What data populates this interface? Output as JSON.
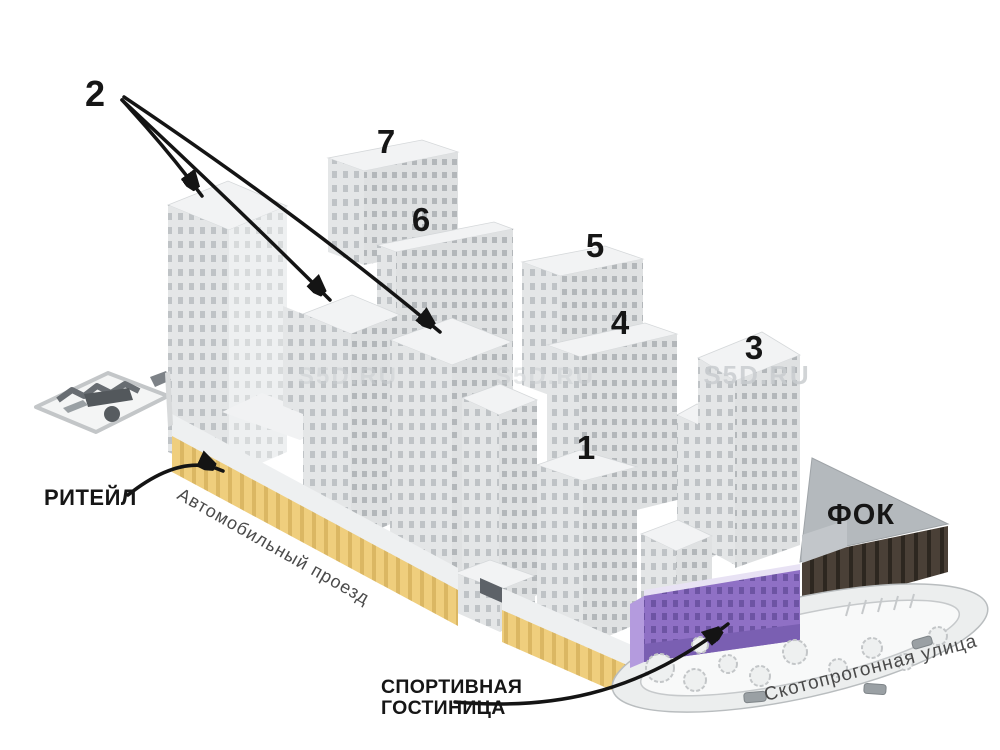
{
  "diagram": {
    "buildings": {
      "n1": "1",
      "n2": "2",
      "n3": "3",
      "n4": "4",
      "n5": "5",
      "n6": "6",
      "n7": "7"
    },
    "labels": {
      "retail": "РИТЕЙЛ",
      "fok": "ФОК",
      "sports_hotel_line1": "СПОРТИВНАЯ",
      "sports_hotel_line2": "ГОСТИНИЦА"
    },
    "streets": {
      "driveway": "Автомобильный проезд",
      "skotoprogonnaya": "Скотопрогонная улица"
    },
    "watermark": "S5D.RU",
    "colors": {
      "retail_yellow": "#efce7d",
      "retail_rib": "#dbb763",
      "hotel_purple": "#8f70c5",
      "hotel_purple_window": "#6d54a3",
      "hotel_purple_light": "#b49bde",
      "hotel_purple_base": "#7a5fb2",
      "fok_brown": "#4a4037",
      "fok_window": "#2d2720",
      "fok_roof": "#b4b9bd",
      "label_black": "#161616",
      "street_text": "#4a4a4a",
      "watermark_gray": "#c9cdd0"
    }
  }
}
